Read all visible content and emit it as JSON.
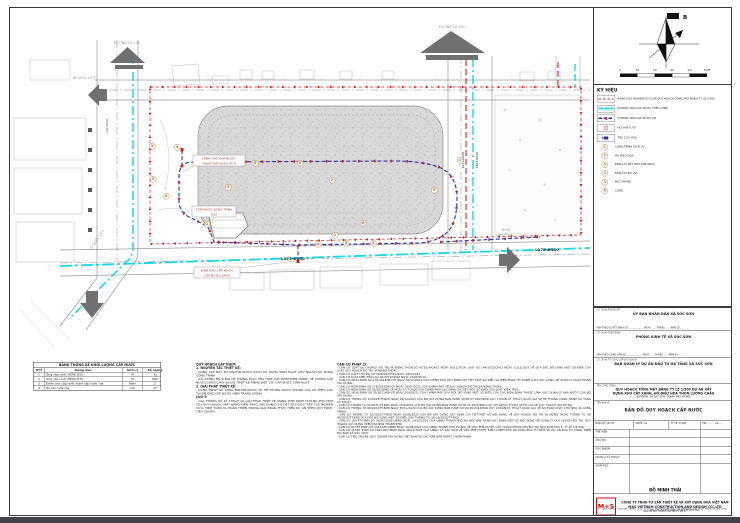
{
  "sheet": {
    "compass_label": "B",
    "scale_ticks": [
      "0",
      "10",
      "20",
      "30",
      "40",
      "50M"
    ]
  },
  "plan": {
    "road_labels": {
      "to_provincial_road_tl": "ĐI TỈNH LỘ 131",
      "to_provincial_road_tr": "ĐI TỈNH LỘ 131",
      "to_national_road_left": "ĐI QUỐC LỘ 3",
      "to_national_road_bottom": "ĐI QUỐC LỘ 3",
      "to_da_phuc_1": "ĐI XÃ",
      "to_da_phuc_2": "ĐA PHÚC"
    },
    "pipe_labels": {
      "bottom_main": "L173-Ø150",
      "bottom_main_2": "L173-Ø150",
      "right_planned": "L211-Ø100",
      "right_existing": "L203-Ø100",
      "left_branch": "L29-Ø100"
    },
    "callouts": {
      "waiting_point_1": "ĐIỂM CHỜ CẤP NƯỚC",
      "waiting_point_2": "TRẠM CẤP NƯỚC RỬA",
      "building_supply_1": "CẤP NƯỚC CÔNG TRÌNH",
      "building_supply_2": "D32",
      "connection_point_1": "ĐIỂM ĐẤU CẤP NƯỚC",
      "connection_point_2": "CẤP NƯỚC SẠCH"
    },
    "markers": [
      {
        "n": "3",
        "x": 152,
        "y": 146
      },
      {
        "n": "4",
        "x": 177,
        "y": 147
      },
      {
        "n": "3",
        "x": 153,
        "y": 179
      },
      {
        "n": "4",
        "x": 166,
        "y": 196
      },
      {
        "n": "1",
        "x": 207,
        "y": 224
      },
      {
        "n": "3",
        "x": 228,
        "y": 187
      },
      {
        "n": "2",
        "x": 332,
        "y": 180
      },
      {
        "n": "6",
        "x": 363,
        "y": 223
      },
      {
        "n": "1",
        "x": 335,
        "y": 235
      },
      {
        "n": "4",
        "x": 318,
        "y": 244
      },
      {
        "n": "5",
        "x": 346,
        "y": 243
      },
      {
        "n": "3",
        "x": 373,
        "y": 243
      },
      {
        "n": "3",
        "x": 434,
        "y": 190
      },
      {
        "n": "1",
        "x": 460,
        "y": 160
      },
      {
        "n": "5",
        "x": 300,
        "y": 163
      },
      {
        "n": "4",
        "x": 255,
        "y": 163
      }
    ]
  },
  "stats_table": {
    "title": "BẢNG THỐNG KÊ KHỐI LƯỢNG CẤP NƯỚC",
    "headers": [
      "STT",
      "Hạng mục",
      "Đơn vị",
      "Số lượng"
    ],
    "rows": [
      [
        "1",
        "Ống cấp nước HDPE D50",
        "M",
        "35"
      ],
      [
        "2",
        "Ống cấp nước HDPE D32",
        "M",
        "562"
      ],
      [
        "3",
        "Điểm chờ cấp nước trạm cấp nước rửa",
        "điểm",
        "2"
      ],
      [
        "4",
        "Hố van tưới cây",
        "Cái",
        "27"
      ]
    ]
  },
  "notes": {
    "lines": [
      {
        "cls": "hd",
        "t": "QUY HOẠCH CẤP NƯỚC"
      },
      {
        "cls": "hd",
        "t": "1. NGUYÊN TẮC THIẾT KẾ:"
      },
      {
        "cls": "",
        "t": "- CUNG CẤP ĐẦY ĐỦ NGUỒN NƯỚC SẠCH SỬ DỤNG SINH HOẠT CHO NGƯỜI SỬ DỤNG CÔNG TRÌNH"
      },
      {
        "cls": "",
        "t": "- XÂY DỰNG BỔ SUNG HỆ THỐNG PCCC PHÙ HỢP QUY ĐỊNH HIỆN HÀNH; HỆ THỐNG CẤP NƯỚC CHỮA CHÁY ĐƯỢC THIẾT KẾ RIÊNG BIỆT VỚI CẤP NƯỚC SINH HOẠT."
      },
      {
        "cls": "hd",
        "t": "2. GIẢI PHÁP THIẾT KẾ:"
      },
      {
        "cls": "",
        "t": "- CÔNG TRÌNH SỬ DỤNG NGUỒN NƯỚC TỪ HỆ THỐNG NƯỚC CHUNG CỦA XÃ THEO CÁC TUYẾN ỐNG CẤP NƯỚC HIỆN TRẠNG CHÍNH."
      },
      {
        "cls": "hd",
        "t": "LƯU Ý:"
      },
      {
        "cls": "",
        "t": "- CÁC THÔNG SỐ KỸ THUẬT VÀ GIẢI PHÁP THIẾT KẾ MANG TÍNH ĐỊNH HƯỚNG PHÙ HỢP VỚI QUY HOẠCH, MẶT BẰNG KIẾN TRÚC; NỘI DUNG CHI TIẾT SẼ ĐƯỢC TIẾP TỤC NGHIÊN CỨU, TÍNH TOÁN VÀ HOÀN THIỆN TRONG GIAI ĐOẠN THỰC HIỆN DỰ ÁN THEO QUY ĐỊNH, TIÊU CHUẨN."
      }
    ]
  },
  "legal": {
    "title": "CĂN CỨ PHÁP LÝ",
    "lines": [
      "- CĂN CỨ LUẬT QUY HOẠCH ĐÔ THỊ VÀ NÔNG THÔN SỐ 47/2024/QH15 NGÀY 26/11/2024; LUẬT SỐ 144/2025/QH15 NGÀY 11/12/2025 VỀ SỬA ĐỔI, BỔ SUNG MỘT SỐ ĐIỀU CỦA LUẬT QUY HOẠCH ĐÔ THỊ VÀ NÔNG THÔN;",
      "- CĂN CỨ LUẬT THỦ ĐÔ SỐ 39/2024/QH15 NGÀY 28/6/2024;",
      "- CĂN CỨ LUẬT KIẾN TRÚC SỐ 40/2019/QH14 NGÀY 13/06/2019;",
      "- CĂN CỨ NGHỊ ĐỊNH SỐ 175/2024/NĐ-CP NGÀY 30/12/2024 CỦA CHÍNH PHỦ QUY ĐỊNH CHI TIẾT MỘT SỐ ĐIỀU VÀ BIỆN PHÁP THI HÀNH LUẬT XÂY DỰNG VỀ QUẢN LÝ HOẠT ĐỘNG XÂY DỰNG;",
      "- CĂN CỨ NGHỊ ĐỊNH SỐ 178/2025/NĐ-CP NGÀY 01/07/2025 CỦA CHÍNH PHỦ VỀ QUY HOẠCH ĐÔ THỊ VÀ NÔNG THÔN;",
      "- CĂN CỨ NGHỊ ĐỊNH SỐ 85/2020/NĐ-CP NGÀY 17/7/2020 CỦA CHÍNH PHỦ QUY ĐỊNH CHI TIẾT MỘT SỐ ĐIỀU CỦA LUẬT KIẾN TRÚC;",
      "- CĂN CỨ NGHỊ ĐỊNH SỐ 35/2023/NĐ-CP NGÀY 20/6/2023 CỦA CHÍNH PHỦ SỬA ĐỔI, BỔ SUNG MỘT SỐ ĐIỀU CỦA CÁC NGHỊ ĐỊNH THUỘC LĨNH VỰC QUẢN LÝ NHÀ NƯỚC CỦA BỘ XÂY DỰNG;",
      "- CĂN CỨ THÔNG TƯ 15/2023/TT-BXD NGÀY 29/12/2023 CỦA BỘ XÂY DỰNG BAN HÀNH QCVN 07:2023/BXD QUY CHUẨN KỸ THUẬT QUỐC GIA VỀ HỆ THỐNG CÔNG TRÌNH HẠ TẦNG KỸ THUẬT;",
      "- CĂN CỨ THÔNG TƯ 01/2021/TT-BXD NGÀY 19/5/2021 CỦA BỘ XÂY DỰNG BAN HÀNH QCVN 01:2021/BXD QUY CHUẨN KỸ THUẬT QUỐC GIA VỀ QUY HOẠCH XÂY DỰNG;",
      "- CĂN CỨ THÔNG TƯ 06/2022/TT-BXD NGÀY 30/11/2022 CỦA BỘ XÂY DỰNG BAN HÀNH QCVN 06:2022/BXD QUY CHUẨN KỸ THUẬT QUỐC GIA VỀ AN TOÀN CHÁY CHO NHÀ VÀ CÔNG TRÌNH;",
      "- CĂN CỨ THÔNG TƯ 16/2025/TT-BXD NGÀY 30/06/2025 CỦA BỘ XÂY DỰNG QUY ĐỊNH CHI TIẾT MỘT SỐ NỘI DUNG VỀ QUY HOẠCH ĐÔ THỊ VÀ NÔNG THÔN; THÔNG TƯ SỐ 45/2025/TT-BXD SỬA ĐỔI, BỔ SUNG MỘT SỐ ĐIỀU CỦA THÔNG TƯ SỐ 16/2025/TT-BXD;",
      "- CĂN CỨ QUYẾT ĐỊNH SỐ 36/2023/QĐ-UBND NGÀY 29/12/2023 CỦA UBND THÀNH PHỐ HÀ NỘI BAN HÀNH QUY ĐỊNH MỘT SỐ NỘI DUNG VỀ QUẢN LÝ QUY HOẠCH ĐÔ THỊ, QUY HOẠCH XÂY DỰNG TRÊN ĐỊA BÀN THÀNH PHỐ;",
      "- CĂN CỨ QUYẾT ĐỊNH SỐ 2012/QĐ-UBND NGÀY 16/04/2024 CỦA UBND THÀNH PHỐ HÀ NỘI VỀ VIỆC PHÊ DUYỆT QUY HOẠCH PHÂN KHU ĐÔ THỊ SÓC SƠN KHU 1, TỶ LỆ 1/2.000;",
      "- CĂN CỨ QUYẾT ĐỊNH SỐ 1625/QĐ-UBND NGÀY 28/11/2025 CỦA UBND XÃ SÓC SƠN VỀ VIỆC PHÊ DUYỆT ĐIỀU CHỈNH CHỦ TRƯƠNG ĐẦU TƯ MỘT SỐ DỰ ÁN ĐẦU TƯ CÔNG TRÊN ĐỊA BÀN XÃ SÓC SƠN;",
      "- CĂN CỨ TIÊU CHUẨN, QUY CHUẨN XÂY DỰNG VIỆT NAM VÀ CÁC VĂN BẢN PHÁP LÝ HIỆN HÀNH."
    ]
  },
  "legend": {
    "title": "KÝ HIỆU",
    "items": [
      {
        "type": "sw-boundary",
        "label": "RANH GIỚI NGHIÊN CỨU LẬP QUY HOẠCH TỔNG MẶT BẰNG TỶ LỆ 1/500"
      },
      {
        "type": "sw-exist",
        "label": "ĐƯỜNG ỐNG CẤP NƯỚC THEO QHPK"
      },
      {
        "type": "sw-plan",
        "label": "ĐƯỜNG ỐNG CẤP NƯỚC QH"
      },
      {
        "type": "sw-valve",
        "label": "HỐ VAN TƯỚI"
      },
      {
        "type": "sw-hydrant",
        "label": "TRỤ CỨU HỎA"
      }
    ],
    "numbered": [
      {
        "n": "1",
        "label": "CÔNG TRÌNH DỊCH VỤ"
      },
      {
        "n": "2",
        "label": "HỒ ĐIỀU HÒA"
      },
      {
        "n": "3",
        "label": "BỒN CÂY KẾT HỢP GHẾ NGỒI"
      },
      {
        "n": "4",
        "label": "BỒN CÂY BÓ VỈA"
      },
      {
        "n": "5",
        "label": "BẬC THANG"
      },
      {
        "n": "6",
        "label": "CỔNG"
      }
    ]
  },
  "title_block": {
    "approve_caption": "CƠ QUAN PHÊ DUYỆT",
    "approve_name": "ỦY BAN NHÂN DÂN XÃ SÓC SƠN",
    "approve_note": "KÈM THEO QUYẾT ĐỊNH SỐ: .................... NGÀY ...... THÁNG ...... NĂM 20......",
    "verify_caption": "CƠ QUAN THẨM ĐỊNH",
    "verify_name": "PHÒNG KINH TẾ XÃ SÓC SƠN",
    "verify_note": "KÈM THEO CÔNG VĂN SỐ: .................... NGÀY ...... THÁNG ...... NĂM 20......",
    "org_caption": "CƠ QUAN TỔ CHỨC LẬP QUY HOẠCH",
    "org_name": "BAN QUẢN LÝ DỰ ÁN ĐẦU TƯ HẠ TẦNG XÃ SÓC SƠN",
    "project_caption": "TÊN CÔNG TRÌNH",
    "project_name_1": "QUY HOẠCH TỔNG MẶT BẰNG TỶ LỆ 1/500 DỰ ÁN XÂY",
    "project_name_2": "DỰNG KHU CÂY XANH, HỒ ĐIỀU HÒA THÔN LƯƠNG CHÂU",
    "project_addr": "ĐỊA ĐIỂM: XÃ SÓC SƠN, THÀNH PHỐ HÀ NỘI",
    "sheet_caption": "TÊN BẢN VẼ",
    "sheet_name": "BẢN ĐỒ QUY HOẠCH CẤP NƯỚC",
    "tbl": {
      "c1": "BẢN VẼ:  QH-07",
      "c2": "GHÉP: A1",
      "c3": "TỶ LỆ:  1/500",
      "c4": "HN, ...... - 20......",
      "r1": "THỂ HIỆN",
      "r2": "CHỦ TRÌ",
      "r3": "CHỦ NHIỆM",
      "r4": "QUẢN LÝ KỸ THUẬT",
      "r5": "GIÁM ĐỐC",
      "director": "ĐỖ MINH THÁI"
    },
    "logo": "M+S",
    "company_1": "CÔNG TY TNHH TƯ VẤN THIẾT KẾ VÀ XÂY DỰNG NHÀ VIỆT NAM",
    "company_2": "MAS VIETNAM CONSTRUCTION AND DESIGN CO.,LTD",
    "company_addr": "ĐỊA CHỈ: XÃ SÓC SƠN, THÀNH PHỐ HÀ NỘI",
    "footer_1": "QUY HOẠCH TỔNG MẶT BẰNG TỶ LỆ 1/500 DỰ ÁN XÂY DỰNG KHU CÂY XANH, HỒ ĐIỀU HÒA THÔN LƯƠNG CHÂU",
    "footer_2": "BẢN ĐỒ QUY HOẠCH CẤP NƯỚC   QH-07"
  },
  "colors": {
    "boundary": "#cf2020",
    "pipe_planned": "#2431b4",
    "pipe_existing": "#19dce8",
    "valve_tick": "#cc2222",
    "marker": "#c8782a",
    "logo_red": "#cc1111"
  }
}
